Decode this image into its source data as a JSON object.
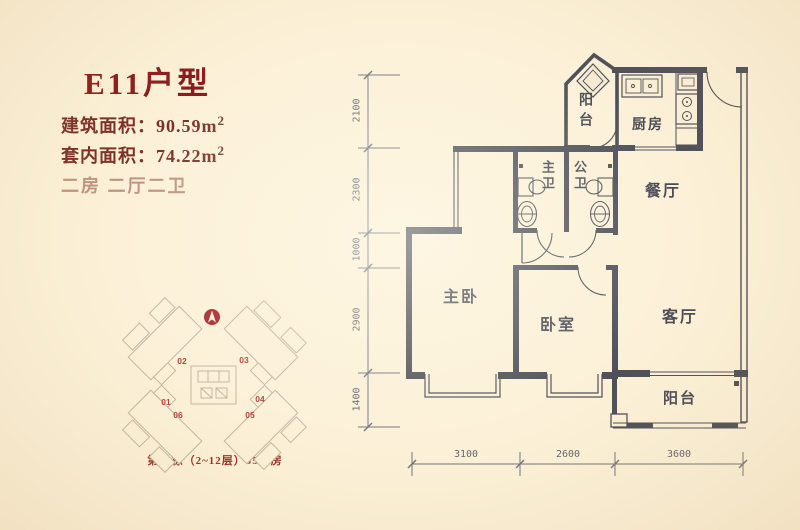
{
  "info": {
    "title": "E11户型",
    "area_lines": [
      {
        "label": "建筑面积：",
        "value": "90.59m",
        "sup": "2"
      },
      {
        "label": "套内面积：",
        "value": "74.22m",
        "sup": "2"
      }
    ],
    "layout": "二房 二厅二卫",
    "caption": "第11栋（2~12层）05号房"
  },
  "site_plan": {
    "units": [
      "01",
      "02",
      "03",
      "04",
      "05",
      "06"
    ]
  },
  "floor_plan": {
    "rooms": {
      "balcony_top": "阳台",
      "kitchen": "厨房",
      "master_bath": "主卫",
      "public_bath": "公卫",
      "dining": "餐厅",
      "master_bedroom": "主卧",
      "bedroom": "卧室",
      "living": "客厅",
      "balcony_bottom": "阳台"
    },
    "dims_left": [
      "2100",
      "2300",
      "1000",
      "2900",
      "1400"
    ],
    "dims_bottom": [
      "3100",
      "2600",
      "3600"
    ]
  },
  "colors": {
    "background": "#fcf1d8",
    "title_red": "#8d1a1d",
    "text_maroon": "#7c2f28",
    "caption_red": "#a03028",
    "wall": "#4e505a",
    "dimension": "#70737d",
    "site_outline": "#c3b7a1",
    "unit_red": "#b5443c"
  }
}
